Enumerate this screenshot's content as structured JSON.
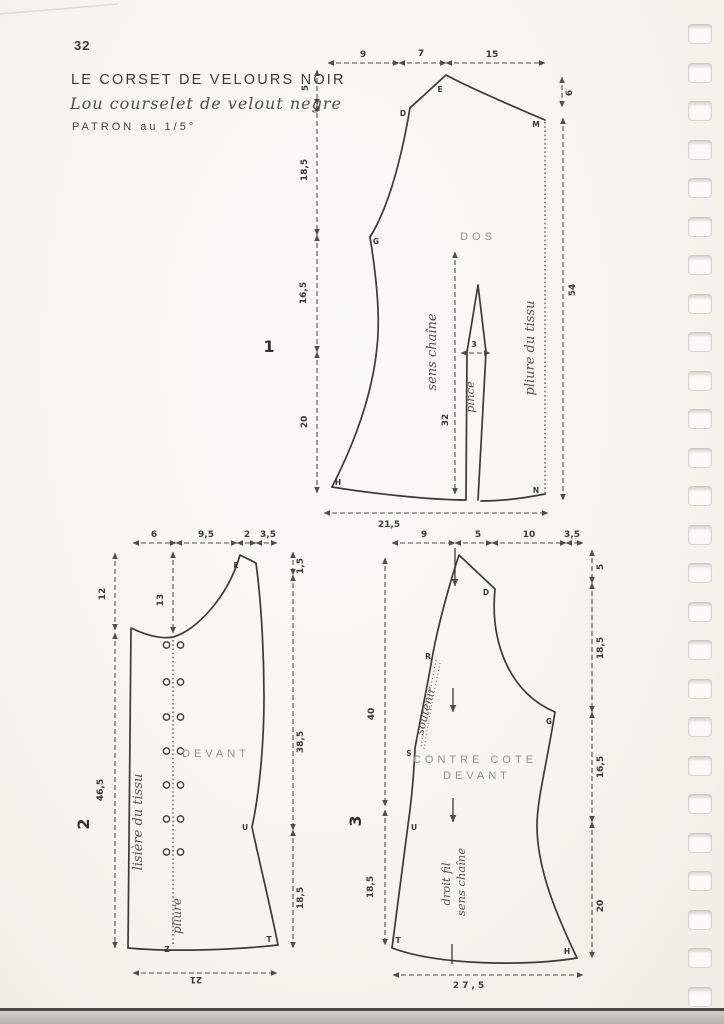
{
  "page": {
    "number": "32",
    "title": "LE CORSET DE VELOURS NOIR",
    "subtitle": "Lou courselet de velout negre",
    "scale_note": "PATRON au 1/5°"
  },
  "colors": {
    "paper": "#f7f5ef",
    "ink": "#3b3a35",
    "muted_label": "#93918b"
  },
  "diagrams": {
    "dos": {
      "figure_number": "1",
      "piece_label": "DOS",
      "dims_top": [
        "9",
        "7",
        "15"
      ],
      "dims_left": [
        "5",
        "18,5",
        "16,5",
        "20"
      ],
      "dim_right_top": "6",
      "dim_right": "54",
      "dim_bottom": "21,5",
      "dart_width": "3",
      "grain_length": "32",
      "grain_label": "sens chaîne",
      "dart_label": "pince",
      "fold_label": "pliure du tissu",
      "points": {
        "D": "D",
        "E": "E",
        "M": "M",
        "G": "G",
        "H": "H",
        "N": "N"
      }
    },
    "devant": {
      "figure_number": "2",
      "piece_label": "DEVANT",
      "dims_top": [
        "6",
        "9,5",
        "2",
        "3,5"
      ],
      "dims_left": [
        "12",
        "46,5"
      ],
      "dim_inner": "13",
      "dims_right": [
        "1,5",
        "38,5",
        "18,5"
      ],
      "dim_bottom": "21",
      "selvage_label": "lisière du tissu",
      "fold_label": "pliure",
      "points": {
        "E": "E",
        "U": "U",
        "Z": "Z",
        "T": "T"
      }
    },
    "contre": {
      "figure_number": "3",
      "piece_label_line1": "CONTRE COTE",
      "piece_label_line2": "DEVANT",
      "dims_top": [
        "9",
        "5",
        "10",
        "3,5"
      ],
      "dims_left": [
        "40",
        "18,5"
      ],
      "dims_right": [
        "5",
        "18,5",
        "16,5",
        "20"
      ],
      "dim_bottom": "27,5",
      "support_label": "soutenir",
      "grain_label_line1": "droit fil",
      "grain_label_line2": "sens chaîne",
      "points": {
        "D": "D",
        "R": "R",
        "S": "S",
        "G": "G",
        "U": "U",
        "T": "T",
        "H": "H"
      }
    }
  }
}
